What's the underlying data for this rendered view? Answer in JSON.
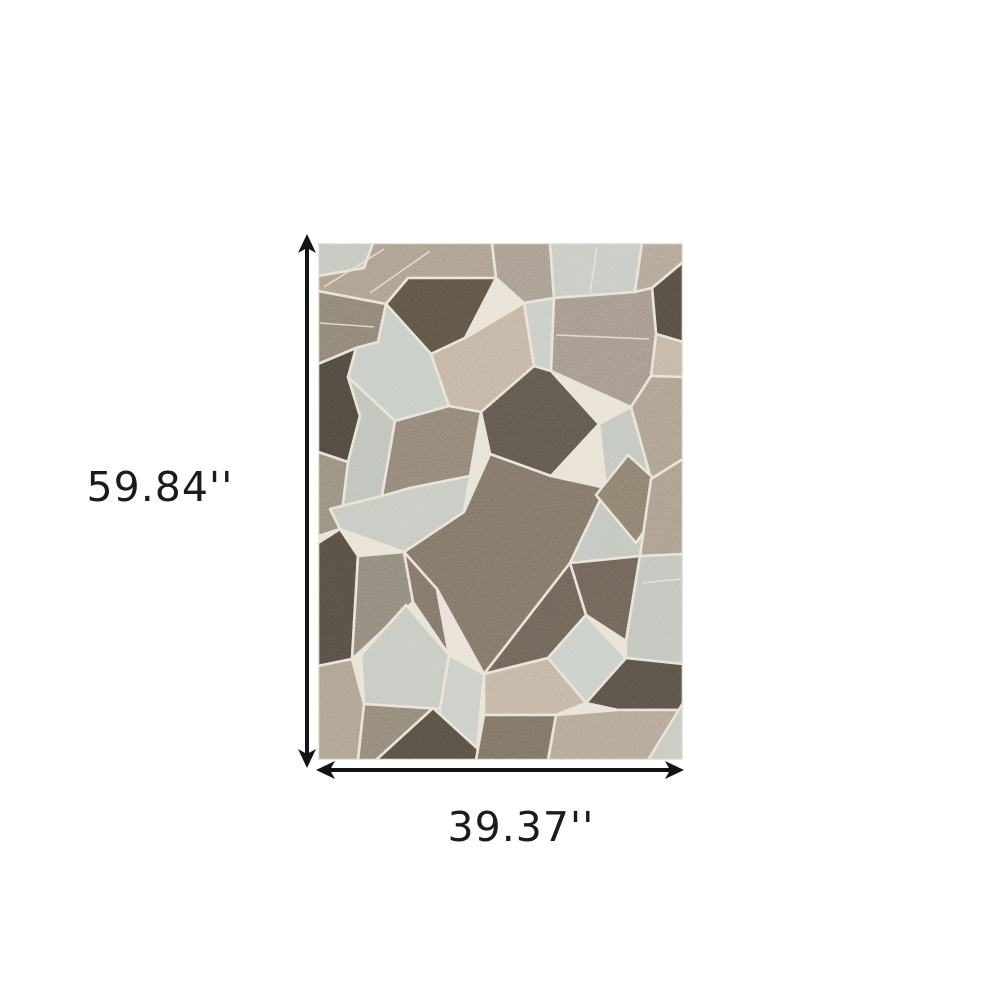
{
  "scene": {
    "background": "#ffffff"
  },
  "dimensions": {
    "height_label": "59.84''",
    "width_label": "39.37''",
    "text_color": "#1b1b1b",
    "arrow_color": "#141414"
  },
  "rug": {
    "grout_color": "#e8e2d4",
    "palette": {
      "pale_sage": "#c5cbc5",
      "pale_grey": "#c2c6bd",
      "light_beige": "#c2b3a1",
      "taupe": "#a69a8c",
      "grey_brown": "#8a8072",
      "medium_brown": "#7d7265",
      "dark_brown": "#5b5245",
      "darkest_brown": "#4e4840"
    },
    "shapes": [
      {
        "p": "0,0 55,0 46,25 0,33",
        "c": "#c2c6bd"
      },
      {
        "p": "55,0 174,0 178,35 90,35 68,61 0,48 0,33 46,25",
        "c": "#aa9c8b"
      },
      {
        "p": "90,35 178,35 147,95 113,111 68,61",
        "c": "#5b5245"
      },
      {
        "p": "174,0 232,0 236,55 206,60 178,35",
        "c": "#a69a8c"
      },
      {
        "p": "232,0 324,0 317,49 236,55",
        "c": "#c6cac2"
      },
      {
        "p": "324,0 365,0 365,19 334,45 317,49",
        "c": "#b0a394"
      },
      {
        "p": "334,45 365,19 365,99 338,91",
        "c": "#544c41"
      },
      {
        "p": "338,91 365,99 365,134 333,133",
        "c": "#c3b4a2"
      },
      {
        "p": "0,48 68,61 60,99 38,105 0,121",
        "c": "#8a8072"
      },
      {
        "p": "38,105 60,99 68,61 113,111 131,163 77,178 30,134",
        "c": "#c5cbc5"
      },
      {
        "p": "113,111 147,95 206,60 216,123 163,169 131,163",
        "c": "#c2b3a1"
      },
      {
        "p": "206,60 236,55 233,128 216,123",
        "c": "#c8ccc4"
      },
      {
        "p": "236,55 317,49 334,45 338,91 333,133 313,164 233,128",
        "c": "#a2958a"
      },
      {
        "p": "0,121 38,105 30,134 42,173 30,219 0,209",
        "c": "#4e4840"
      },
      {
        "p": "30,134 77,178 64,253 12,266 30,219 42,173",
        "c": "#bcc1b8"
      },
      {
        "p": "77,178 131,163 163,169 152,233 92,245 64,253",
        "c": "#8d8173"
      },
      {
        "p": "163,169 216,123 233,128 281,181 233,233 172,211",
        "c": "#5e564b"
      },
      {
        "p": "281,181 313,164 333,236 288,245",
        "c": "#c1c6be"
      },
      {
        "p": "313,164 333,133 365,134 365,216 333,236",
        "c": "#aa9d8d"
      },
      {
        "p": "0,209 30,219 22,286 0,293",
        "c": "#968b7c"
      },
      {
        "p": "12,266 64,253 92,245 152,233 146,269 86,309 22,286",
        "c": "#c5c9c1"
      },
      {
        "p": "146,269 172,211 233,233 288,245 252,320 166,431 119,346 86,309",
        "c": "#7d7265"
      },
      {
        "p": "288,245 333,236 322,313 252,320",
        "c": "#c0c5bd"
      },
      {
        "p": "310,212 352,250 318,300 278,252",
        "c": "#8a7c6c"
      },
      {
        "p": "333,236 365,216 365,311 322,313",
        "c": "#a89b8b"
      },
      {
        "p": "0,300 22,286 40,313 34,416 0,423",
        "c": "#554d42"
      },
      {
        "p": "40,313 86,309 95,359 45,406 34,416",
        "c": "#8e8577"
      },
      {
        "p": "86,309 119,346 131,412 95,359",
        "c": "#7d7265"
      },
      {
        "p": "88,362 131,412 122,466 46,461 43,412",
        "c": "#c5c9c0"
      },
      {
        "p": "252,320 322,313 308,398 268,372",
        "c": "#6b6155"
      },
      {
        "p": "322,313 365,311 365,421 308,415 308,398",
        "c": "#bfc4bb"
      },
      {
        "p": "166,431 252,320 268,372 230,415",
        "c": "#6b6155"
      },
      {
        "p": "268,372 308,415 268,460 230,415",
        "c": "#c9cec8"
      },
      {
        "p": "166,431 230,415 268,460 238,472 166,472",
        "c": "#c2b3a1"
      },
      {
        "p": "268,460 308,415 365,421 365,467 300,467",
        "c": "#575046"
      },
      {
        "p": "238,472 300,467 365,467 365,517 230,517",
        "c": "#b2a493"
      },
      {
        "p": "330,517 365,460 365,517",
        "c": "#c4c8bf"
      },
      {
        "p": "0,423 34,416 46,461 40,517 0,517",
        "c": "#ab9e8e"
      },
      {
        "p": "46,461 122,466 122,517 40,517",
        "c": "#8f8475"
      },
      {
        "p": "131,412 166,431 158,517 122,517 122,466",
        "c": "#c9cdc5"
      },
      {
        "p": "115,465 172,517 58,517",
        "c": "#564e43"
      },
      {
        "p": "158,517 166,472 238,472 230,517",
        "c": "#7a7061"
      }
    ],
    "seams": [
      {
        "x1": 66,
        "y1": 6,
        "x2": 6,
        "y2": 44
      },
      {
        "x1": 112,
        "y1": 8,
        "x2": 52,
        "y2": 50
      },
      {
        "x1": 279,
        "y1": 4,
        "x2": 272,
        "y2": 50
      },
      {
        "x1": 238,
        "y1": 92,
        "x2": 331,
        "y2": 96
      },
      {
        "x1": 2,
        "y1": 80,
        "x2": 56,
        "y2": 84
      },
      {
        "x1": 324,
        "y1": 340,
        "x2": 363,
        "y2": 336
      }
    ]
  }
}
